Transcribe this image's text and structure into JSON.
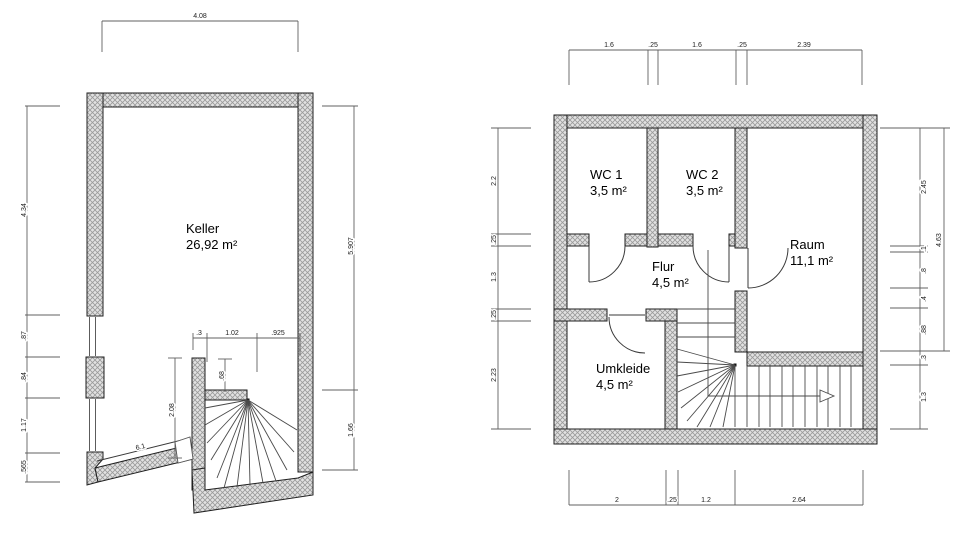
{
  "canvas": {
    "background": "#ffffff",
    "wall_outline": "#1f1f1f",
    "hatch_fill": "#e2e2e2",
    "hatch_line": "#9a9a9a",
    "dim_color": "#606060"
  },
  "left_plan": {
    "title": "Keller floor plan",
    "room_label": {
      "name": "Keller",
      "area": "26,92 m²"
    },
    "dim_top": "4.08",
    "dims_left": [
      "4.34",
      ".87",
      ".84",
      "1.17",
      ".565"
    ],
    "dims_right": [
      "5.907",
      "1.66"
    ],
    "dims_stair_top": [
      ".3",
      "1.02",
      ".925"
    ],
    "dim_stair_width": ".68",
    "dim_stair_height": "2.08",
    "dim_ramp": "6.1"
  },
  "right_plan": {
    "title": "Upper floor plan",
    "rooms": [
      {
        "name": "WC 1",
        "area": "3,5 m²"
      },
      {
        "name": "WC 2",
        "area": "3,5 m²"
      },
      {
        "name": "Raum",
        "area": "11,1 m²"
      },
      {
        "name": "Flur",
        "area": "4,5 m²"
      },
      {
        "name": "Umkleide",
        "area": "4,5 m²"
      }
    ],
    "dims_top": [
      "1.6",
      ".25",
      "1.6",
      ".25",
      "2.39"
    ],
    "dims_left": [
      "2.2",
      ".25",
      "1.3",
      ".25",
      "2.23"
    ],
    "dims_right": [
      "2.45",
      ".1",
      ".8",
      ".4",
      ".88",
      ".3",
      "1.3"
    ],
    "dim_right_total": "4.63",
    "dims_bottom": [
      "2",
      ".25",
      "1.2",
      "2.64"
    ]
  }
}
